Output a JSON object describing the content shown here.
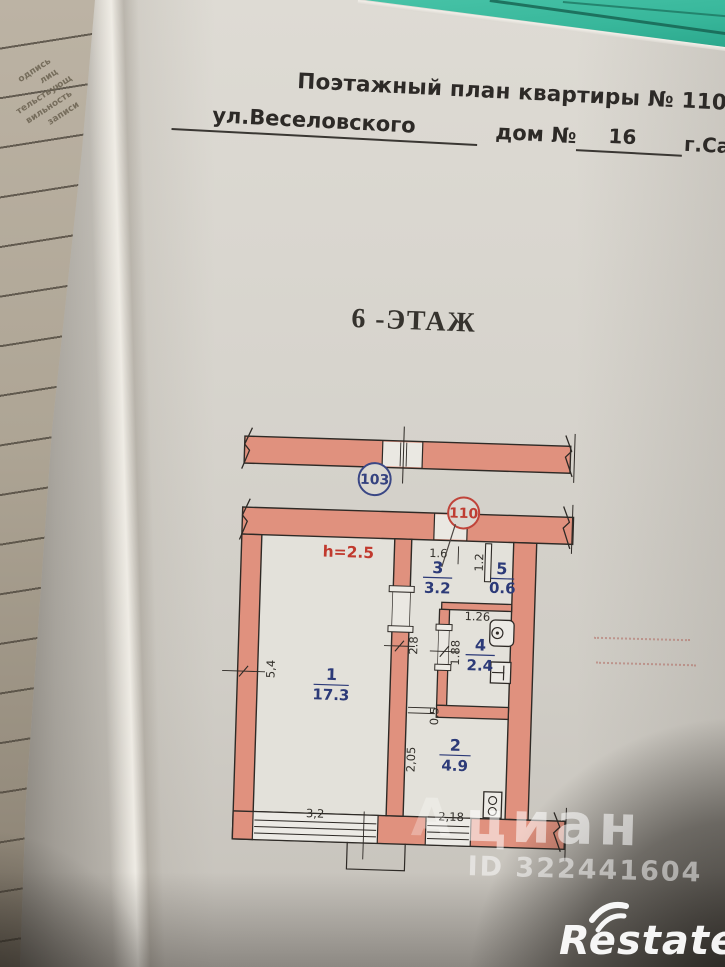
{
  "colors": {
    "table_surface": "#38b79b",
    "wall_fill": "#e0917e",
    "line_black": "#2e2a26",
    "room_label_blue": "#2c3a78",
    "unit_103_blue": "#3a4785",
    "unit_110_red": "#c0443a",
    "height_note_red": "#c13a2e"
  },
  "notebook_margin_text": {
    "line1": "одпись лиц",
    "line2": "тельствующ",
    "line3": "вильность",
    "line4": "записи"
  },
  "header": {
    "title": "Поэтажный план квартиры № 110",
    "street": "ул.Веселовского",
    "house_label": "дом №",
    "house_number": "16",
    "city": "г.Саранска"
  },
  "floor_heading": "6 -ЭТАЖ",
  "plan": {
    "height_note": "h=2.5",
    "units": {
      "neighbor": "103",
      "apartment": "110"
    },
    "rooms": {
      "r1": {
        "num": "1",
        "area": "17.3"
      },
      "r2": {
        "num": "2",
        "area": "4.9"
      },
      "r3": {
        "num": "3",
        "area": "3.2"
      },
      "r4": {
        "num": "4",
        "area": "2.4"
      },
      "r5": {
        "num": "5",
        "area": "0.6"
      }
    },
    "dims": {
      "r1_left": "5,4",
      "r1_bottom": "3,2",
      "hall_top": "1.6",
      "hall_side": "2.8",
      "r5_left": "1.2",
      "r4_top": "1.26",
      "r4_left": "1.88",
      "passage": "0.5",
      "kitchen_left": "2,05",
      "kitchen_bottom": "2,18"
    }
  },
  "watermark": {
    "partial": "А",
    "brand": "циан",
    "id": "ID 322441604"
  },
  "brand_logo": "Restate"
}
